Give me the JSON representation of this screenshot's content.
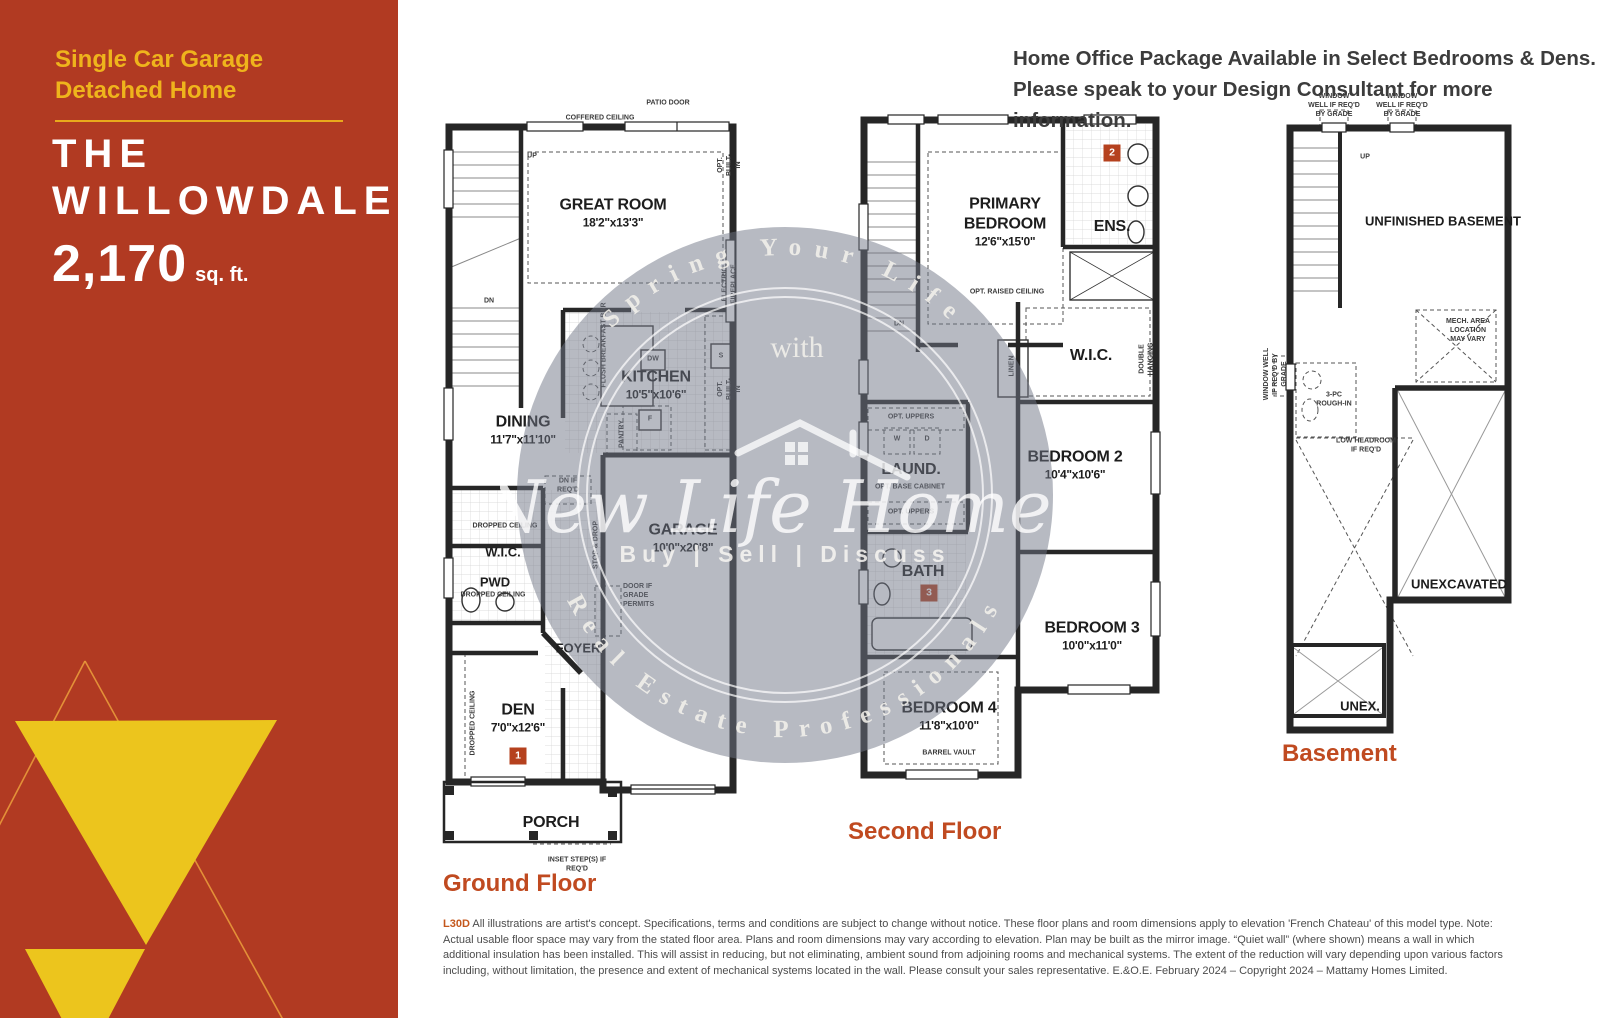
{
  "colors": {
    "brand_red": "#b13a22",
    "brand_gold": "#eec11c",
    "floor_title": "#c04a20",
    "badge_red": "#b5411e"
  },
  "sidebar": {
    "subtitle_line1": "Single Car Garage",
    "subtitle_line2": "Detached Home",
    "title_line1": "THE",
    "title_line2": "WILLOWDALE",
    "area_value": "2,170",
    "area_unit": "sq. ft."
  },
  "header": {
    "line1": "Home Office Package Available in Select Bedrooms & Dens.",
    "line2": "Please speak to your Design Consultant for more information."
  },
  "watermark": {
    "arc_top": "Spring Your Life",
    "arc_with": "with",
    "name": "New Life Homes",
    "tagline": "Buy | Sell | Discuss",
    "arc_bottom": "Real Estate Professionals"
  },
  "floors": {
    "ground": {
      "label": "Ground Floor",
      "rooms": {
        "great_room": {
          "name": "GREAT ROOM",
          "dims": "18'2\"x13'3\""
        },
        "kitchen": {
          "name": "KITCHEN",
          "dims": "10'5\"x10'6\""
        },
        "dining": {
          "name": "DINING",
          "dims": "11'7\"x11'10\""
        },
        "wic": {
          "name": "W.I.C."
        },
        "pwd": {
          "name": "PWD"
        },
        "foyer": {
          "name": "FOYER"
        },
        "garage": {
          "name": "GARAGE",
          "dims": "10'0\"x20'8\""
        },
        "den": {
          "name": "DEN",
          "dims": "7'0\"x12'6\"",
          "badge": "1"
        },
        "porch": {
          "name": "PORCH"
        }
      },
      "annotations": {
        "patio_door": "PATIO DOOR",
        "coffered_ceiling": "COFFERED CEILING",
        "opt_built_in": "OPT. BUILT-IN",
        "electric_fireplace": "ELECTRIC FIREPLACE",
        "opt_built_in2": "OPT. BUILT-IN",
        "up": "UP",
        "dn": "DN",
        "flush_breakfast_bar": "FLUSH BREAKFAST BAR",
        "dw": "DW",
        "s": "S",
        "f": "F",
        "pantry": "PANTRY",
        "dn_if_reqd": "DN IF REQ'D",
        "dropped_ceiling_wic": "DROPPED CEILING",
        "dropped_ceiling_pwd": "DROPPED CEILING",
        "stop_drop": "STOP & DROP",
        "door_if_grade": "DOOR IF GRADE PERMITS",
        "dropped_ceiling_den": "DROPPED CEILING",
        "inset_steps": "INSET STEP(S) IF REQ'D"
      }
    },
    "second": {
      "label": "Second Floor",
      "rooms": {
        "primary": {
          "name": "PRIMARY BEDROOM",
          "dims": "12'6\"x15'0\"",
          "badge": "2"
        },
        "ens": {
          "name": "ENS."
        },
        "wic": {
          "name": "W.I.C."
        },
        "laundry": {
          "name": "LAUND."
        },
        "bath": {
          "name": "BATH",
          "badge": "3"
        },
        "bedroom2": {
          "name": "BEDROOM 2",
          "dims": "10'4\"x10'6\""
        },
        "bedroom3": {
          "name": "BEDROOM 3",
          "dims": "10'0\"x11'0\""
        },
        "bedroom4": {
          "name": "BEDROOM 4",
          "dims": "11'8\"x10'0\""
        }
      },
      "annotations": {
        "opt_raised_ceiling": "OPT. RAISED CEILING",
        "dn": "DN",
        "linen": "LINEN",
        "double_hanging": "DOUBLE HANGING",
        "opt_uppers": "OPT. UPPERS",
        "w": "W",
        "d": "D",
        "opt_base_cabinet": "OPT. BASE CABINET",
        "opt_uppers2": "OPT. UPPERS",
        "barrel_vault": "BARREL VAULT"
      }
    },
    "basement": {
      "label": "Basement",
      "rooms": {
        "unfinished": {
          "name": "UNFINISHED BASEMENT"
        },
        "unexcavated": {
          "name": "UNEXCAVATED"
        },
        "unex": {
          "name": "UNEX."
        }
      },
      "annotations": {
        "window_well1": "WINDOW WELL IF REQ'D BY GRADE",
        "window_well2": "WINDOW WELL IF REQ'D BY GRADE",
        "window_well_left": "WINDOW WELL IF REQ'D BY GRADE",
        "up": "UP",
        "mech_area": "MECH. AREA LOCATION MAY VARY",
        "rough_in": "3-PC ROUGH-IN",
        "low_headroom": "LOW HEADROOM IF REQ'D"
      }
    }
  },
  "disclaimer": {
    "code": "L30D",
    "text": "All illustrations are artist's concept. Specifications, terms and conditions are subject to change without notice. These floor plans and room dimensions apply to elevation 'French Chateau' of this model type. Note: Actual usable floor space may vary from the stated floor area. Plans and room dimensions may vary according to elevation. Plan may be built as the mirror image. “Quiet wall” (where shown) means a wall in which additional insulation has been installed. This will assist in reducing, but not eliminating, ambient sound from adjoining rooms and mechanical systems. The extent of the reduction will vary depending upon various factors including, without limitation, the presence and extent of mechanical systems located in the wall. Please consult your sales representative. E.&O.E. February 2024 – Copyright 2024 – Mattamy Homes Limited."
  }
}
